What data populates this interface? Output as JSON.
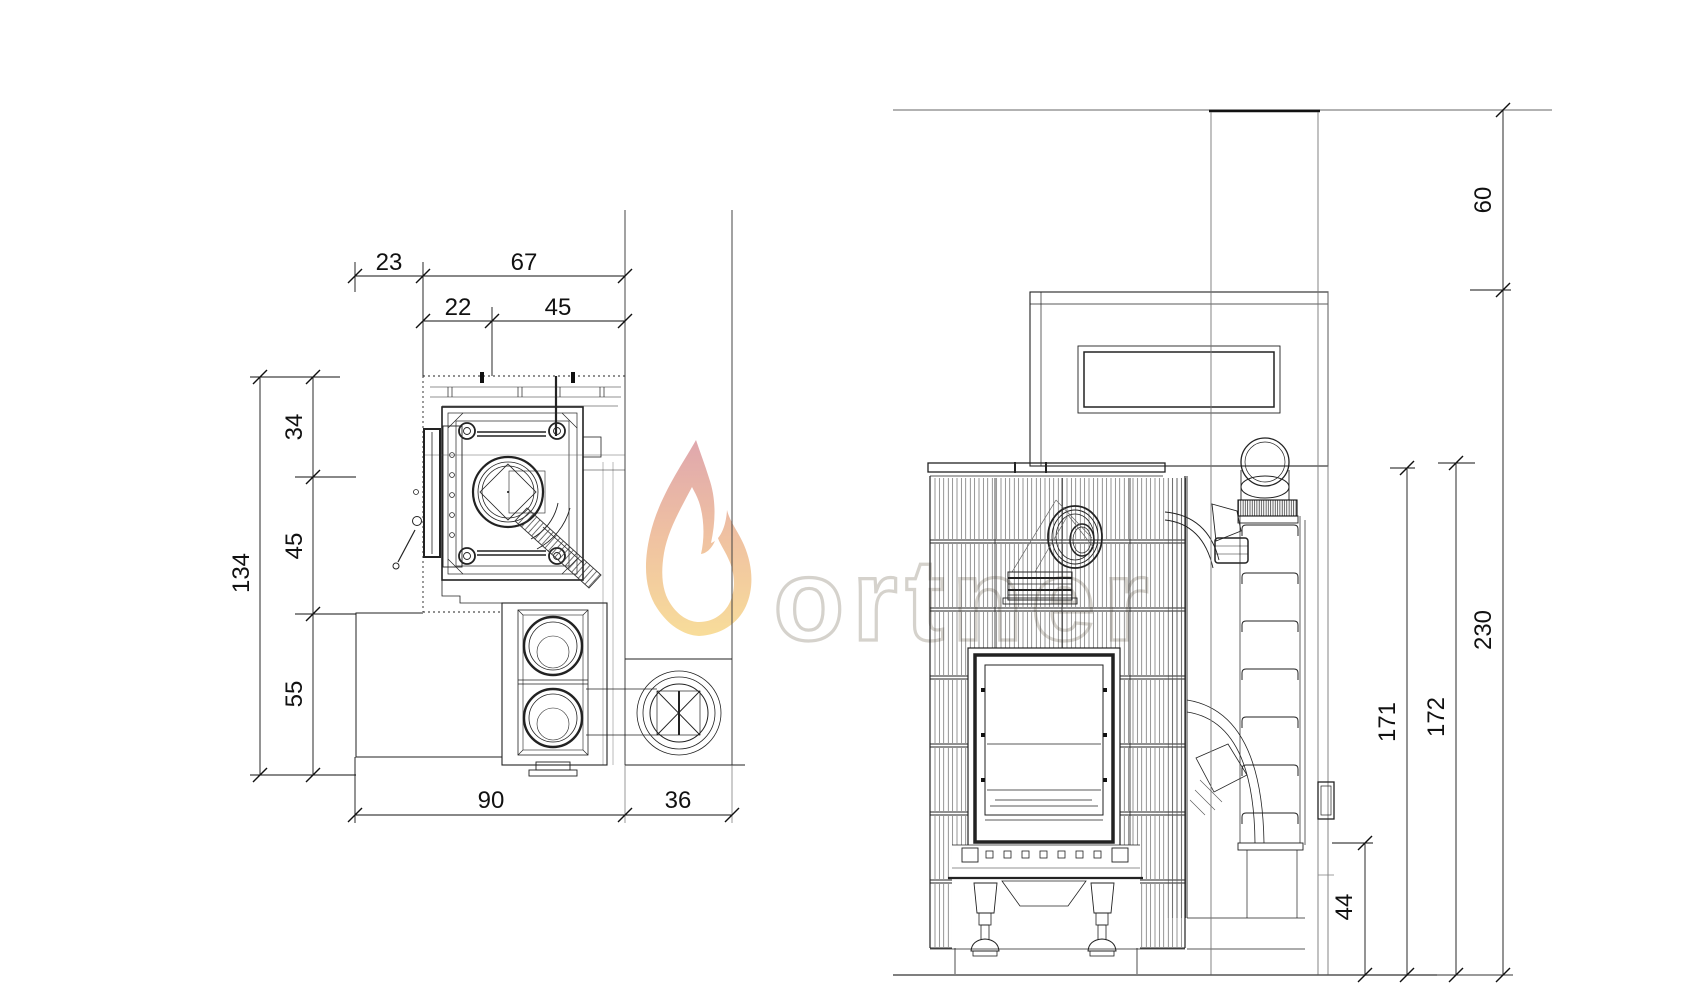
{
  "watermark": {
    "brand": "ortner",
    "letter_color": "#d5d2cc",
    "flame_top": "#dc9da4",
    "flame_mid": "#eebb97",
    "flame_bottom": "#f7d98f"
  },
  "plan_view": {
    "dim_23": "23",
    "dim_67": "67",
    "dim_22": "22",
    "dim_45_top": "45",
    "dim_34": "34",
    "dim_45_left": "45",
    "dim_55": "55",
    "dim_134": "134",
    "dim_90": "90",
    "dim_36": "36"
  },
  "elevation_view": {
    "dim_60": "60",
    "dim_230": "230",
    "dim_171": "171",
    "dim_172": "172",
    "dim_44": "44"
  }
}
